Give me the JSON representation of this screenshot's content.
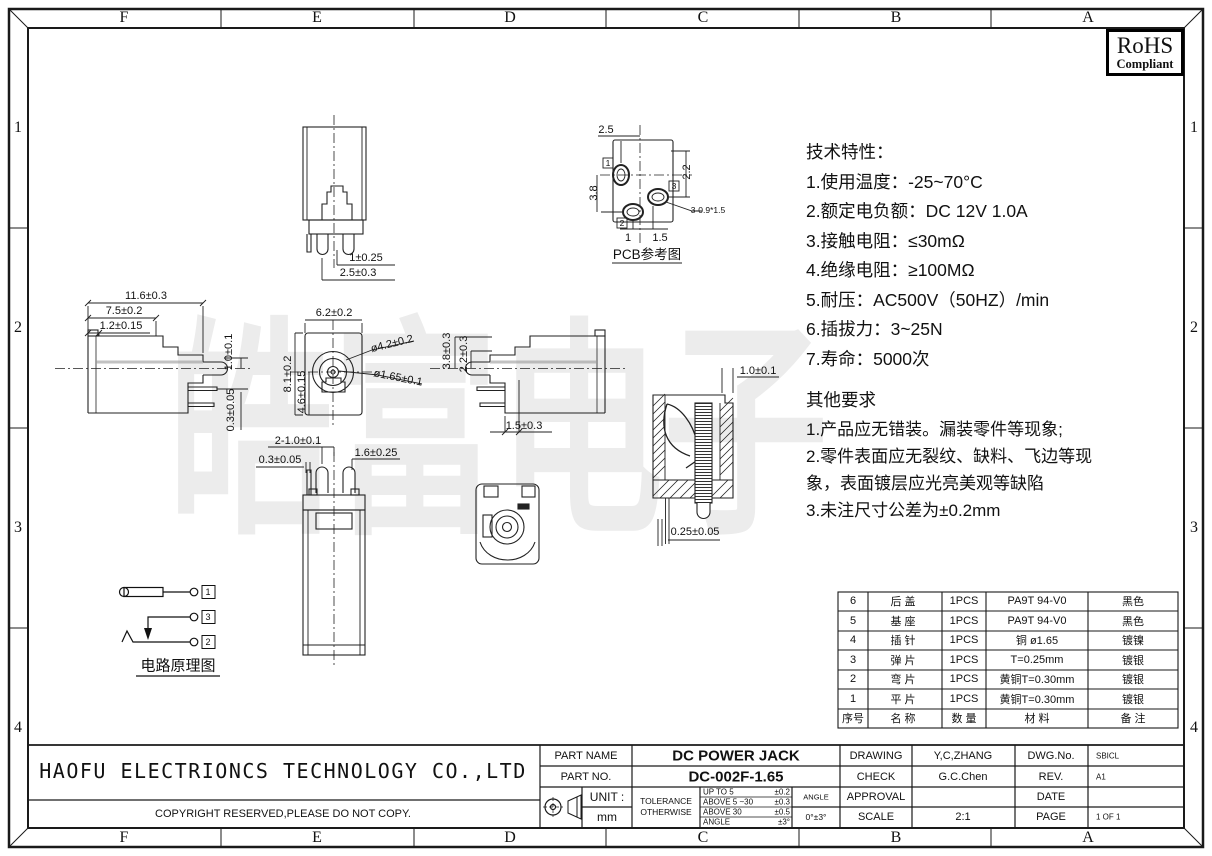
{
  "watermark": "皓富电子",
  "frame": {
    "cols": [
      "F",
      "E",
      "D",
      "C",
      "B",
      "A"
    ],
    "rows": [
      "1",
      "2",
      "3",
      "4"
    ]
  },
  "rohs": {
    "line1": "RoHS",
    "line2": "Compliant"
  },
  "notes": {
    "tech_title": "技术特性：",
    "tech_items": [
      "1.使用温度：-25~70°C",
      "2.额定电负额：DC 12V 1.0A",
      "3.接触电阻：≤30mΩ",
      "4.绝缘电阻：≥100MΩ",
      "5.耐压：AC500V（50HZ）/min",
      "6.插拔力：3~25N",
      "7.寿命：5000次"
    ],
    "other_title": "其他要求",
    "other_items": [
      "1.产品应无错装。漏装零件等现象;",
      "2.零件表面应无裂纹、缺料、飞边等现",
      "象，表面镀层应光亮美观等缺陷",
      "3.未注尺寸公差为±0.2mm"
    ]
  },
  "dims": {
    "tv1": "1±0.25",
    "tv2": "2.5±0.3",
    "pcb_top": "2.5",
    "pcb_right": "2.2",
    "pcb_left": "3.8",
    "pcb_b1": "1",
    "pcb_b2": "1.5",
    "pcb_callout": "3-0.9*1.5",
    "pcb_l1": "1",
    "pcb_l2": "3",
    "pcb_l3": "2",
    "pcb_title": "PCB参考图",
    "sl1": "11.6±0.3",
    "sl2": "7.5±0.2",
    "sl3": "1.2±0.15",
    "sl4": "1.0±0.1",
    "sl5": "0.3±0.05",
    "fv1": "6.2±0.2",
    "fv2": "8.1±0.2",
    "fv3": "4.6±0.15",
    "fv4": "ø4.2±0.2",
    "fv5": "ø1.65±0.1",
    "sr1": "3.8±0.3",
    "sr2": "2.2±0.3",
    "sr3": "1.5±0.3",
    "bv1": "2-1.0±0.1",
    "bv2": "0.3±0.05",
    "bv3": "1.6±0.25",
    "sec1": "1.0±0.1",
    "sec2": "0.25±0.05",
    "cir1": "1",
    "cir2": "3",
    "cir3": "2",
    "cir_title": "电路原理图"
  },
  "bom": {
    "headers": {
      "no": "序号",
      "name": "名 称",
      "qty": "数 量",
      "material": "材 料",
      "remark": "备 注"
    },
    "rows": [
      {
        "no": "6",
        "name": "后 盖",
        "qty": "1PCS",
        "material": "PA9T 94-V0",
        "remark": "黑色"
      },
      {
        "no": "5",
        "name": "基 座",
        "qty": "1PCS",
        "material": "PA9T 94-V0",
        "remark": "黑色"
      },
      {
        "no": "4",
        "name": "插 针",
        "qty": "1PCS",
        "material": "铜 ø1.65",
        "remark": "镀镍"
      },
      {
        "no": "3",
        "name": "弹 片",
        "qty": "1PCS",
        "material": "T=0.25mm",
        "remark": "镀银"
      },
      {
        "no": "2",
        "name": "弯 片",
        "qty": "1PCS",
        "material": "黄铜T=0.30mm",
        "remark": "镀银"
      },
      {
        "no": "1",
        "name": "平 片",
        "qty": "1PCS",
        "material": "黄铜T=0.30mm",
        "remark": "镀银"
      }
    ]
  },
  "title_block": {
    "company": "HAOFU ELECTRIONCS TECHNOLOGY CO.,LTD",
    "copyright": "COPYRIGHT RESERVED,PLEASE DO NOT COPY.",
    "part_name_label": "PART NAME",
    "part_name": "DC POWER JACK",
    "part_no_label": "PART NO.",
    "part_no": "DC-002F-1.65",
    "drawing_label": "DRAWING",
    "drawing": "Y,C,ZHANG",
    "check_label": "CHECK",
    "check": "G.C.Chen",
    "approval_label": "APPROVAL",
    "scale_label": "SCALE",
    "scale": "2:1",
    "dwg_no_label": "DWG.No.",
    "dwg_no": "SBICL",
    "rev_label": "REV.",
    "rev": "A1",
    "date_label": "DATE",
    "page_label": "PAGE",
    "page": "1 OF 1",
    "unit_label": "UNIT :",
    "unit": "mm",
    "tolerance_label": "TOLERANCE",
    "otherwise_label": "OTHERWISE",
    "tol_rows": [
      {
        "range": "UP TO 5",
        "val": "±0.2"
      },
      {
        "range": "ABOVE 5 ~30",
        "val": "±0.3"
      },
      {
        "range": "ABOVE 30",
        "val": "±0.5"
      },
      {
        "range": "ANGLE",
        "val": "±3°"
      }
    ],
    "angle_label": "ANGLE",
    "angle_val": "0°±3°"
  }
}
